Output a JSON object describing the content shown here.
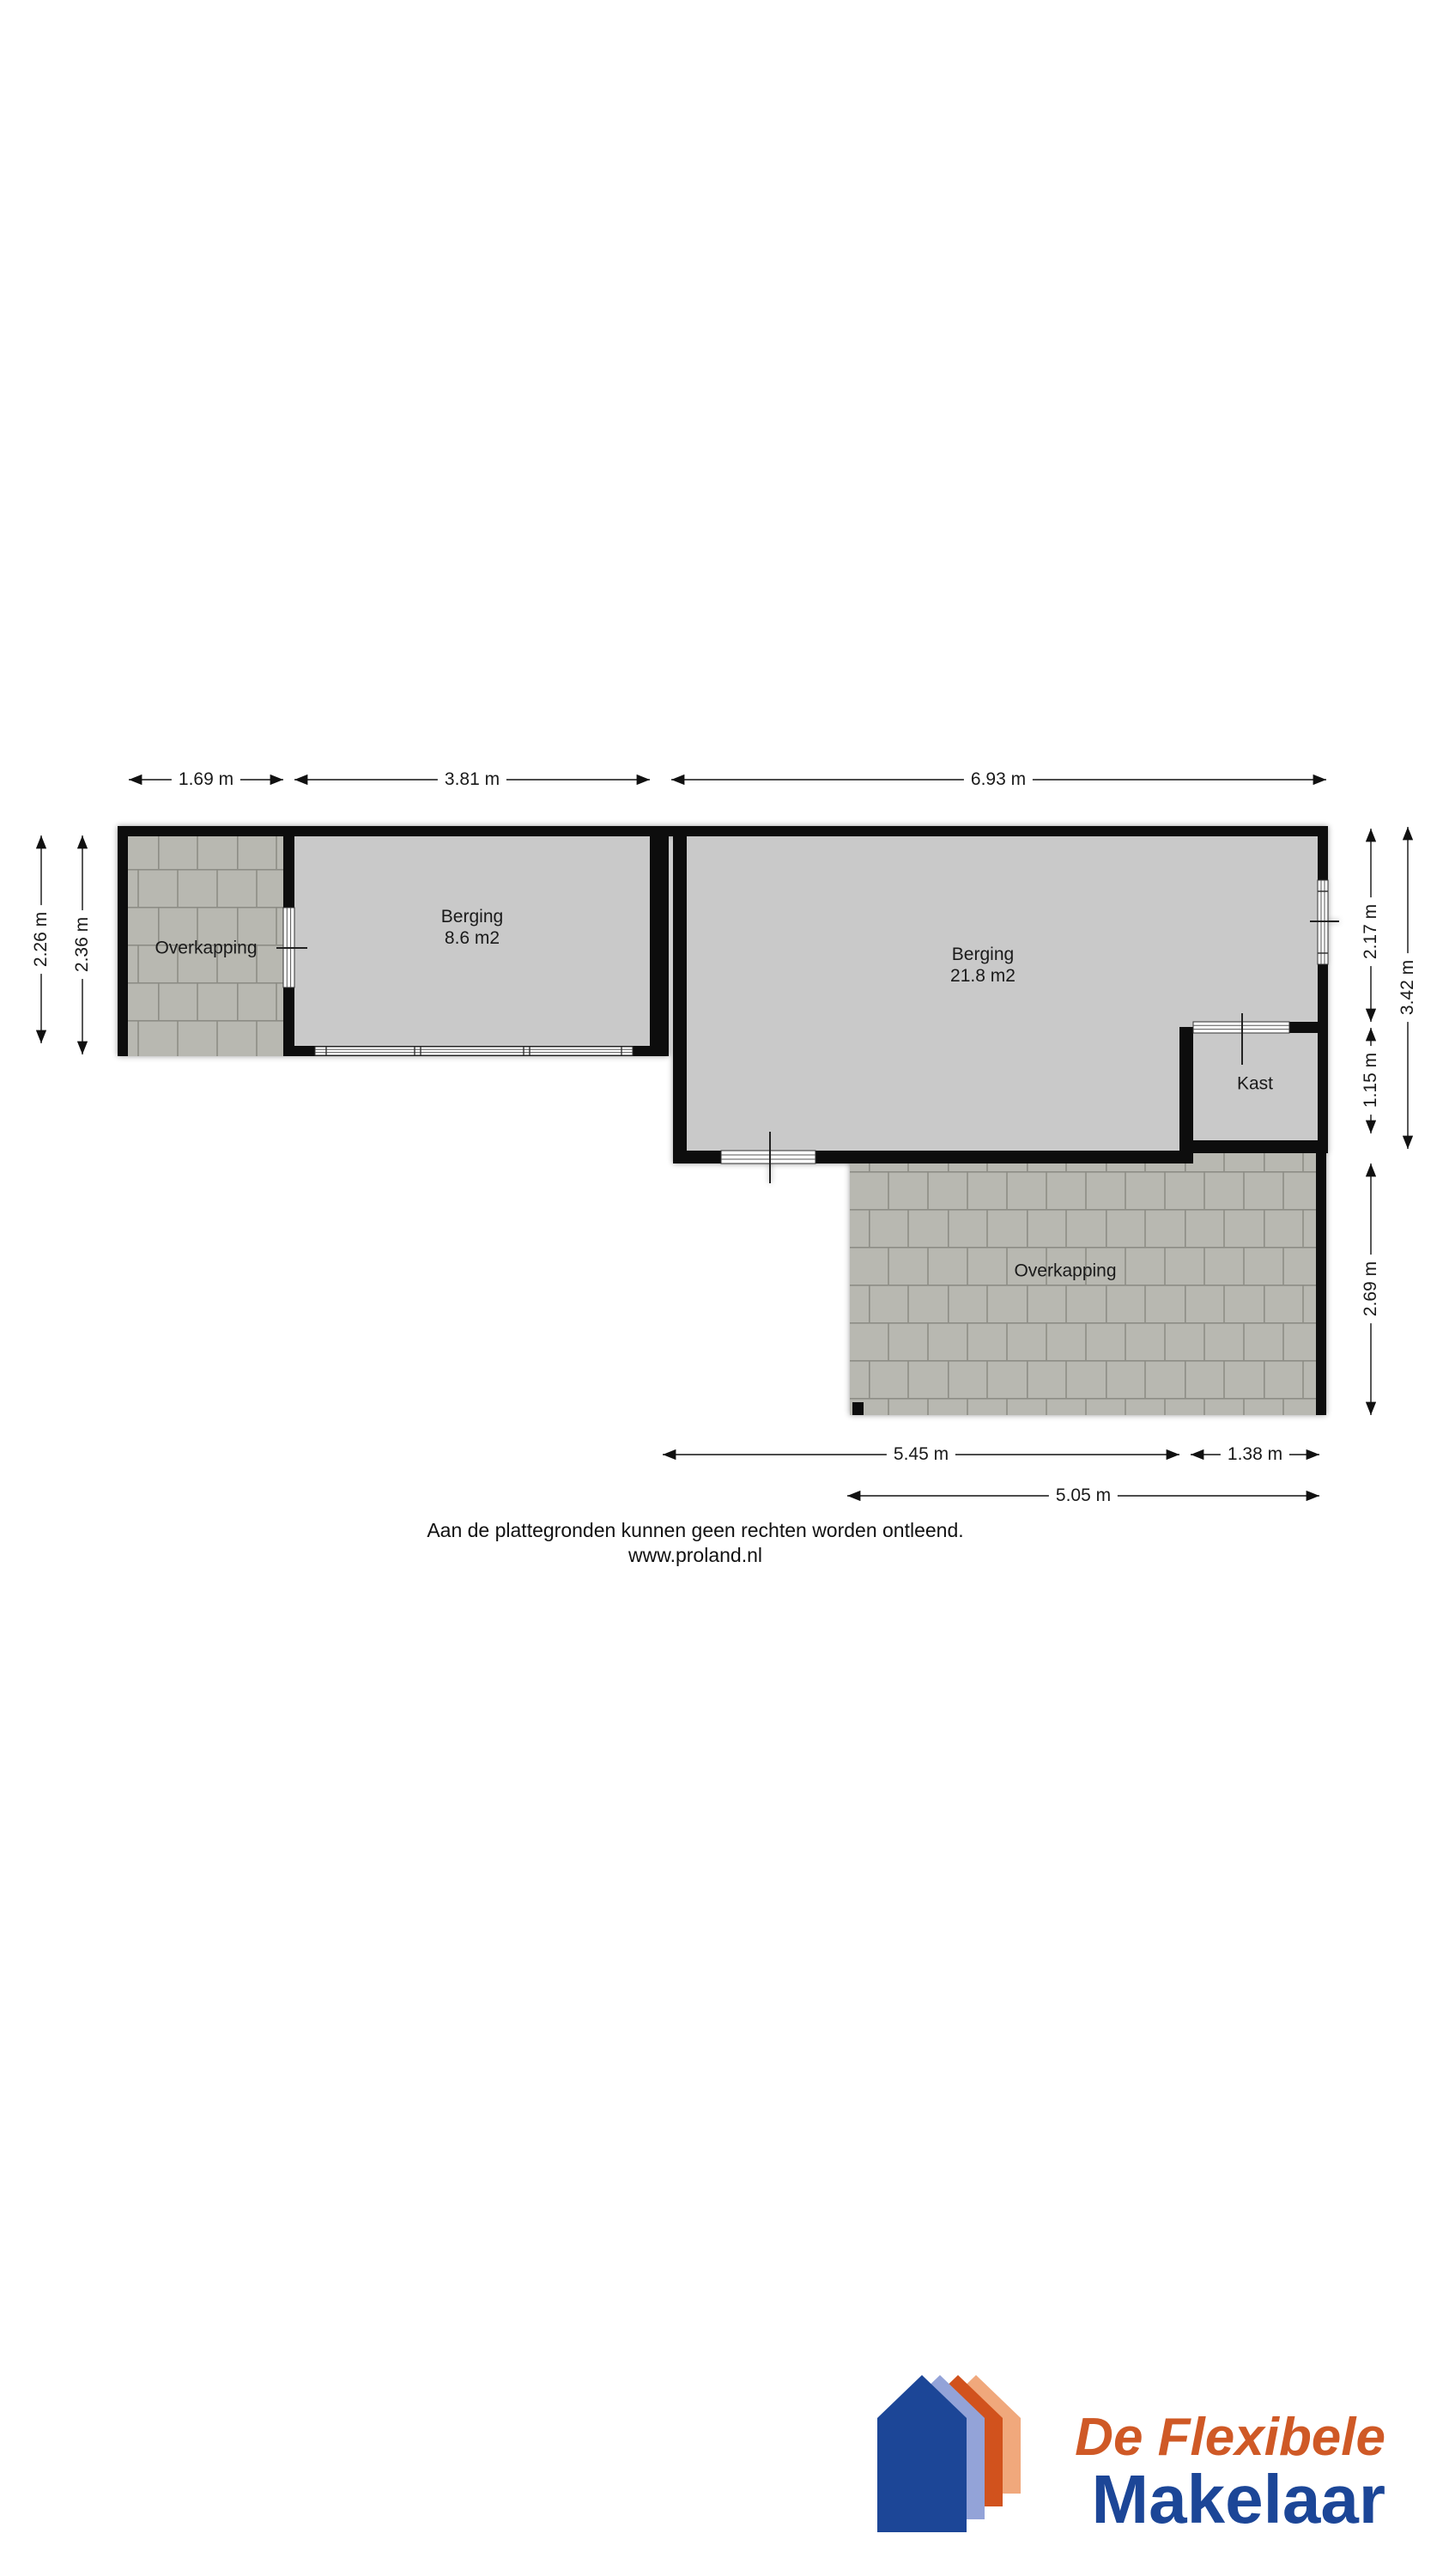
{
  "plan": {
    "rooms": [
      {
        "id": "overkapping-left",
        "label": "Overkapping"
      },
      {
        "id": "berging-small",
        "label": "Berging",
        "area": "8.6 m2"
      },
      {
        "id": "berging-large",
        "label": "Berging",
        "area": "21.8 m2"
      },
      {
        "id": "kast",
        "label": "Kast"
      },
      {
        "id": "overkapping-bottom",
        "label": "Overkapping"
      }
    ],
    "dims": {
      "top": [
        "1.69 m",
        "3.81 m",
        "6.93 m"
      ],
      "left": [
        "2.26 m",
        "2.36 m"
      ],
      "right": [
        "2.17 m",
        "3.42 m",
        "1.15 m",
        "2.69 m"
      ],
      "bottom": [
        "5.45 m",
        "1.38 m",
        "5.05 m"
      ]
    }
  },
  "disclaimer": {
    "line1": "Aan de plattegronden kunnen geen rechten worden ontleend.",
    "line2": "www.proland.nl"
  },
  "logo": {
    "tagline": "De Flexibele",
    "name": "Makelaar"
  },
  "colors": {
    "wall": "#0c0c0c",
    "floor": "#c9c9c9",
    "tile": "#b8b8b1",
    "grout": "#8d8d86",
    "logo_blue": "#1c4697",
    "logo_periwinkle": "#93a3d8",
    "logo_orange": "#d1521d",
    "logo_salmon": "#f0a87c",
    "logo_text_orange": "#cf5926"
  }
}
